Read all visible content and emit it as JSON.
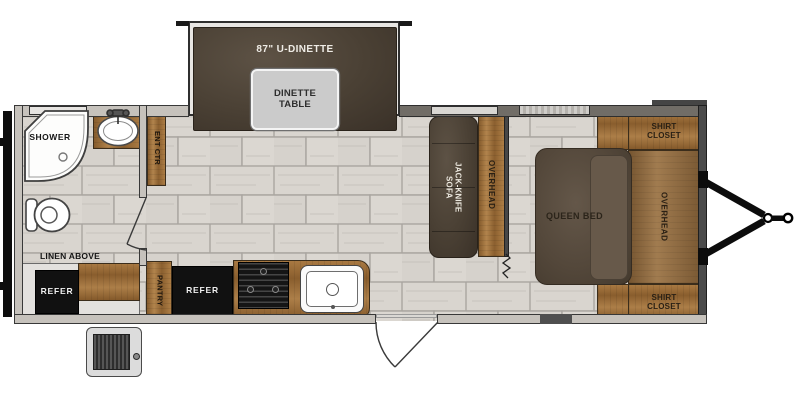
{
  "floorplan": {
    "slideout": {
      "dinette_label": "87\" U-DINETTE",
      "table_label": "DINETTE\nTABLE"
    },
    "bathroom": {
      "shower_label": "SHOWER",
      "linen_label": "LINEN ABOVE"
    },
    "kitchen": {
      "ent_ctr_label": "ENT CTR",
      "pantry_label": "PANTRY",
      "refer_left_label": "REFER",
      "refer_right_label": "REFER"
    },
    "living": {
      "sofa_label": "JACK-KNIFE\nSOFA",
      "overhead_label": "OVERHEAD"
    },
    "bedroom": {
      "bed_label": "QUEEN BED",
      "overhead_label": "OVERHEAD",
      "shirt_closet_top_label": "SHIRT\nCLOSET",
      "shirt_closet_bottom_label": "SHIRT\nCLOSET"
    }
  },
  "colors": {
    "wood_cabinet": "#9e6f3a",
    "upholstery_dark": "#4a4034",
    "bed_mattress": "#584c3e",
    "appliance_black": "#111111",
    "floor_tile": "#d8d4ce",
    "wall_light": "#c6c2bc",
    "wall_dark": "#716d67",
    "table_gray": "#cbcbcb"
  }
}
